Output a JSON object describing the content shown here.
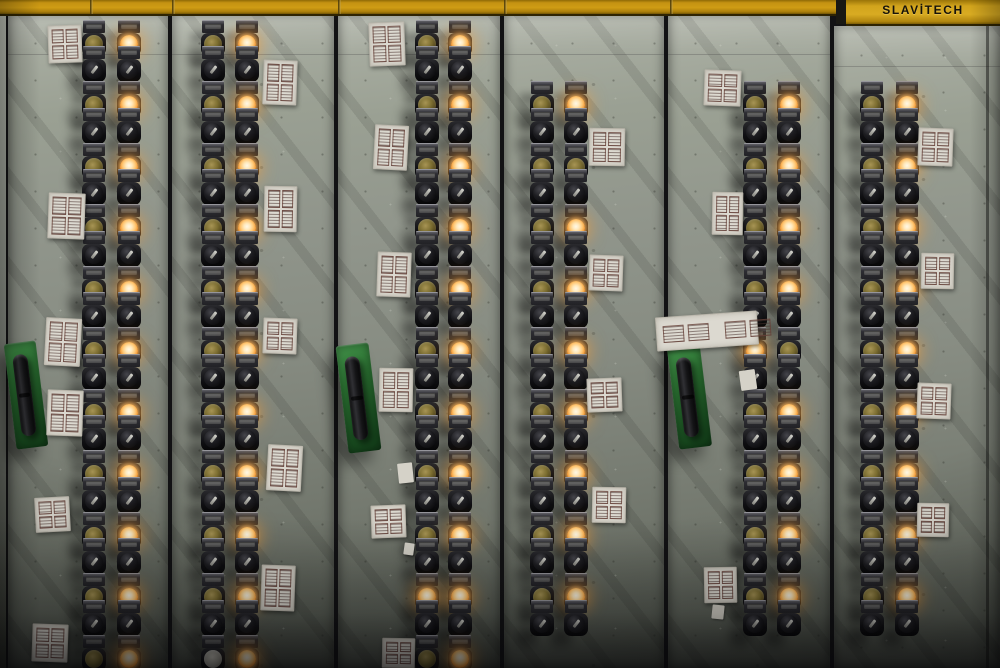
{
  "brand": {
    "name": "SLAVİTECH"
  },
  "colors": {
    "band_yellow": "#c79311",
    "band_yellow_bright": "#d3a41c",
    "panel_gray_light": "#aeb3a8",
    "panel_gray_dark": "#474c44",
    "handle_green": "#2d7a34",
    "lamp_lit_glow": "#ffb84d",
    "lamp_unlit_amber": "#8b7c3c",
    "switch_black": "#1b1b1e",
    "paper_label": "#dcd9d0"
  },
  "band": {
    "left_height": 14,
    "right_height": 24,
    "notch_x": 836,
    "notch_w": 10,
    "right_x": 846,
    "seams": [
      90,
      172,
      338,
      504,
      670
    ]
  },
  "geometry": {
    "first_lamp_row_y": 44.5,
    "group_spacing": 61.5,
    "switch_row_offset": 26.5
  },
  "panels": [
    {
      "id": "panel-1",
      "x": 8,
      "w": 160,
      "top": 14,
      "columns": [
        94,
        129
      ],
      "groups": [
        [
          "dim",
          "lit"
        ],
        [
          "dim",
          "lit"
        ],
        [
          "dim",
          "lit"
        ],
        [
          "dim",
          "lit"
        ],
        [
          "dim",
          "lit"
        ],
        [
          "dim",
          "lit"
        ],
        [
          "dim",
          "lit"
        ],
        [
          "dim",
          "lit"
        ],
        [
          "dim",
          "lit"
        ],
        [
          "dim",
          "lit"
        ]
      ],
      "start_group": 0,
      "partial": [
        "dim",
        "lit"
      ]
    },
    {
      "id": "panel-2",
      "x": 172,
      "w": 162,
      "top": 14,
      "columns": [
        213,
        247
      ],
      "groups": [
        [
          "dim",
          "lit"
        ],
        [
          "dim",
          "lit"
        ],
        [
          "dim",
          "lit"
        ],
        [
          "dim",
          "lit"
        ],
        [
          "dim",
          "lit"
        ],
        [
          "dim",
          "lit"
        ],
        [
          "dim",
          "lit"
        ],
        [
          "dim",
          "lit"
        ],
        [
          "dim",
          "lit"
        ],
        [
          "dim",
          "lit"
        ]
      ],
      "start_group": 0,
      "partial": [
        "pale",
        "lit"
      ]
    },
    {
      "id": "panel-3",
      "x": 338,
      "w": 162,
      "top": 14,
      "columns": [
        427,
        460
      ],
      "groups": [
        [
          "dim",
          "lit"
        ],
        [
          "dim",
          "lit"
        ],
        [
          "dim",
          "lit"
        ],
        [
          "dim",
          "lit"
        ],
        [
          "dim",
          "lit"
        ],
        [
          "dim",
          "lit"
        ],
        [
          "dim",
          "lit"
        ],
        [
          "dim",
          "lit"
        ],
        [
          "dim",
          "lit"
        ],
        [
          "lit",
          "lit"
        ]
      ],
      "start_group": 0,
      "partial": [
        "dim",
        "lit"
      ]
    },
    {
      "id": "panel-4",
      "x": 504,
      "w": 160,
      "top": 14,
      "columns": [
        542,
        576
      ],
      "groups": [
        [
          "dim",
          "lit"
        ],
        [
          "dim",
          "dim"
        ],
        [
          "dim",
          "lit"
        ],
        [
          "dim",
          "lit"
        ],
        [
          "dim",
          "lit"
        ],
        [
          "dim",
          "lit"
        ],
        [
          "dim",
          "lit"
        ],
        [
          "dim",
          "lit"
        ],
        [
          "dim",
          "lit"
        ]
      ],
      "start_group": 1,
      "partial": null
    },
    {
      "id": "panel-5",
      "x": 668,
      "w": 162,
      "top": 14,
      "columns": [
        755,
        789
      ],
      "groups": [
        [
          "dim",
          "lit"
        ],
        [
          "dim",
          "lit"
        ],
        [
          "dim",
          "lit"
        ],
        [
          "dim",
          "lit"
        ],
        [
          "lit",
          "dim"
        ],
        [
          "dim",
          "lit"
        ],
        [
          "dim",
          "lit"
        ],
        [
          "dim",
          "lit"
        ],
        [
          "dim",
          "lit"
        ]
      ],
      "start_group": 1,
      "partial": null
    },
    {
      "id": "panel-6",
      "x": 834,
      "w": 166,
      "top": 26,
      "columns": [
        872,
        907
      ],
      "groups": [
        [
          "dim",
          "lit"
        ],
        [
          "dim",
          "lit"
        ],
        [
          "dim",
          "lit"
        ],
        [
          "dim",
          "lit"
        ],
        [
          "dim",
          "lit"
        ],
        [
          "dim",
          "lit"
        ],
        [
          "dim",
          "lit"
        ],
        [
          "dim",
          "lit"
        ],
        [
          "dim",
          "lit"
        ]
      ],
      "start_group": 1,
      "partial": null
    }
  ],
  "labels": [
    {
      "x": 48,
      "y": 25,
      "w": 34,
      "h": 38,
      "rot": -2,
      "type": "grid4"
    },
    {
      "x": 48,
      "y": 193,
      "w": 37,
      "h": 46,
      "rot": 2,
      "type": "grid4"
    },
    {
      "x": 45,
      "y": 318,
      "w": 36,
      "h": 48,
      "rot": 3,
      "type": "grid4"
    },
    {
      "x": 47,
      "y": 390,
      "w": 36,
      "h": 46,
      "rot": 2,
      "type": "grid4"
    },
    {
      "x": 35,
      "y": 497,
      "w": 35,
      "h": 35,
      "rot": -3,
      "type": "grid4"
    },
    {
      "x": 32,
      "y": 624,
      "w": 36,
      "h": 38,
      "rot": 2,
      "type": "grid4"
    },
    {
      "x": 263,
      "y": 60,
      "w": 34,
      "h": 45,
      "rot": 2,
      "type": "grid4"
    },
    {
      "x": 264,
      "y": 186,
      "w": 33,
      "h": 46,
      "rot": 1,
      "type": "grid4"
    },
    {
      "x": 263,
      "y": 318,
      "w": 34,
      "h": 36,
      "rot": 2,
      "type": "grid4"
    },
    {
      "x": 267,
      "y": 445,
      "w": 35,
      "h": 46,
      "rot": 3,
      "type": "grid4"
    },
    {
      "x": 261,
      "y": 565,
      "w": 34,
      "h": 46,
      "rot": 2,
      "type": "grid4"
    },
    {
      "x": 369,
      "y": 22,
      "w": 36,
      "h": 44,
      "rot": -2,
      "type": "grid4"
    },
    {
      "x": 374,
      "y": 125,
      "w": 34,
      "h": 45,
      "rot": 3,
      "type": "grid4"
    },
    {
      "x": 377,
      "y": 252,
      "w": 34,
      "h": 45,
      "rot": 2,
      "type": "grid4"
    },
    {
      "x": 379,
      "y": 368,
      "w": 34,
      "h": 44,
      "rot": 1,
      "type": "grid4"
    },
    {
      "x": 371,
      "y": 505,
      "w": 35,
      "h": 33,
      "rot": -2,
      "type": "grid4"
    },
    {
      "x": 382,
      "y": 638,
      "w": 33,
      "h": 30,
      "rot": 1,
      "type": "grid4"
    },
    {
      "x": 589,
      "y": 128,
      "w": 36,
      "h": 38,
      "rot": 1,
      "type": "grid4"
    },
    {
      "x": 589,
      "y": 255,
      "w": 34,
      "h": 36,
      "rot": 2,
      "type": "grid4"
    },
    {
      "x": 587,
      "y": 378,
      "w": 35,
      "h": 34,
      "rot": -2,
      "type": "grid4"
    },
    {
      "x": 592,
      "y": 487,
      "w": 34,
      "h": 36,
      "rot": 1,
      "type": "grid4"
    },
    {
      "x": 704,
      "y": 70,
      "w": 37,
      "h": 36,
      "rot": 2,
      "type": "grid4"
    },
    {
      "x": 712,
      "y": 192,
      "w": 31,
      "h": 43,
      "rot": 1,
      "type": "grid4"
    },
    {
      "x": 704,
      "y": 567,
      "w": 33,
      "h": 36,
      "rot": -1,
      "type": "grid4"
    },
    {
      "x": 918,
      "y": 128,
      "w": 35,
      "h": 38,
      "rot": 2,
      "type": "grid4"
    },
    {
      "x": 921,
      "y": 253,
      "w": 33,
      "h": 36,
      "rot": 1,
      "type": "grid4"
    },
    {
      "x": 917,
      "y": 383,
      "w": 34,
      "h": 36,
      "rot": 2,
      "type": "grid4"
    },
    {
      "x": 917,
      "y": 503,
      "w": 32,
      "h": 34,
      "rot": 1,
      "type": "grid4"
    },
    {
      "x": 656,
      "y": 314,
      "w": 102,
      "h": 34,
      "rot": -4,
      "type": "strip"
    }
  ],
  "scraps": [
    {
      "x": 398,
      "y": 463,
      "w": 15,
      "h": 20,
      "rot": -6
    },
    {
      "x": 404,
      "y": 543,
      "w": 10,
      "h": 12,
      "rot": 8
    },
    {
      "x": 740,
      "y": 370,
      "w": 16,
      "h": 20,
      "rot": -8
    },
    {
      "x": 712,
      "y": 605,
      "w": 12,
      "h": 14,
      "rot": 6
    }
  ],
  "handles": [
    {
      "x": 10,
      "y": 342,
      "w": 32,
      "h": 106,
      "rot": -7
    },
    {
      "x": 342,
      "y": 344,
      "w": 33,
      "h": 108,
      "rot": -7
    },
    {
      "x": 673,
      "y": 346,
      "w": 33,
      "h": 102,
      "rot": -7
    }
  ],
  "seam_lines": [
    {
      "x": 986,
      "y": 26,
      "h": 642
    }
  ]
}
